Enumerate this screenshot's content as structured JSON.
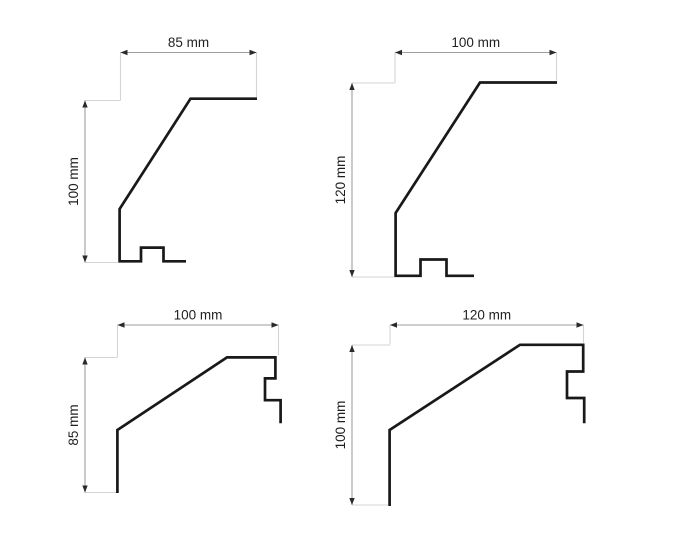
{
  "canvas": {
    "width": 675,
    "height": 540,
    "background": "#ffffff"
  },
  "colors": {
    "profile_stroke": "#191919",
    "dim_line": "#9e9e9e",
    "extension_line": "#d4d4d4",
    "arrow_fill": "#2a2a2a",
    "label_text": "#1f1f1f"
  },
  "diagrams": [
    {
      "name": "top-left-profile",
      "width_label": "85 mm",
      "height_label": "100 mm",
      "width_mm": 85,
      "height_mm": 100,
      "h_dim": {
        "x1": 120.5,
        "x2": 256.5,
        "y": 52.5
      },
      "v_dim": {
        "x": 85,
        "y1": 100.5,
        "y2": 262.5
      },
      "extensions": [
        [
          120.5,
          52.5,
          120.5,
          100.5
        ],
        [
          256.5,
          52.5,
          256.5,
          97.0
        ],
        [
          85,
          100.5,
          120.5,
          100.5
        ],
        [
          85,
          262.5,
          118,
          262.5
        ]
      ],
      "profile_points": [
        [
          257.0,
          98.7
        ],
        [
          190.5,
          98.7
        ],
        [
          119.6,
          209.0
        ],
        [
          119.6,
          261.3
        ],
        [
          141.0,
          261.3
        ],
        [
          141.0,
          247.6
        ],
        [
          163.5,
          247.6
        ],
        [
          163.5,
          261.3
        ],
        [
          186.0,
          261.3
        ]
      ]
    },
    {
      "name": "top-right-profile",
      "width_label": "100 mm",
      "height_label": "120 mm",
      "width_mm": 100,
      "height_mm": 120,
      "h_dim": {
        "x1": 395,
        "x2": 556.5,
        "y": 52.5
      },
      "v_dim": {
        "x": 352,
        "y1": 83,
        "y2": 277
      },
      "extensions": [
        [
          395,
          52.5,
          395,
          83
        ],
        [
          556.5,
          52.5,
          556.5,
          80.5
        ],
        [
          352,
          83,
          395,
          83
        ],
        [
          352,
          277,
          394,
          277
        ]
      ],
      "profile_points": [
        [
          557.0,
          82.5
        ],
        [
          480.0,
          82.5
        ],
        [
          395.6,
          213.0
        ],
        [
          395.6,
          275.8
        ],
        [
          420.5,
          275.8
        ],
        [
          420.5,
          259.5
        ],
        [
          446.5,
          259.5
        ],
        [
          446.5,
          275.8
        ],
        [
          474.0,
          275.8
        ]
      ]
    },
    {
      "name": "bottom-left-profile",
      "width_label": "100 mm",
      "height_label": "85 mm",
      "width_mm": 100,
      "height_mm": 85,
      "h_dim": {
        "x1": 117.5,
        "x2": 278.5,
        "y": 325
      },
      "v_dim": {
        "x": 85,
        "y1": 357.5,
        "y2": 492.5
      },
      "extensions": [
        [
          117.5,
          325,
          117.5,
          357
        ],
        [
          278.5,
          325,
          278.5,
          355
        ],
        [
          85,
          357.5,
          117.5,
          357.5
        ],
        [
          85,
          492.5,
          116,
          492.5
        ]
      ],
      "profile_points": [
        [
          117.4,
          493.0
        ],
        [
          117.4,
          430.0
        ],
        [
          227.0,
          357.4
        ],
        [
          275.4,
          357.4
        ],
        [
          275.4,
          378.4
        ],
        [
          265.0,
          378.4
        ],
        [
          265.0,
          400.2
        ],
        [
          280.6,
          400.2
        ],
        [
          280.6,
          423.3
        ]
      ]
    },
    {
      "name": "bottom-right-profile",
      "width_label": "120 mm",
      "height_label": "100 mm",
      "width_mm": 120,
      "height_mm": 100,
      "h_dim": {
        "x1": 390,
        "x2": 583.5,
        "y": 325
      },
      "v_dim": {
        "x": 352,
        "y1": 345,
        "y2": 505
      },
      "extensions": [
        [
          390,
          325,
          390,
          344.5
        ],
        [
          583.5,
          325,
          583.5,
          343
        ],
        [
          352,
          345,
          390,
          345
        ],
        [
          352,
          505,
          388,
          505
        ]
      ],
      "profile_points": [
        [
          389.6,
          506.0
        ],
        [
          389.6,
          430.0
        ],
        [
          520.0,
          344.8
        ],
        [
          583.2,
          344.8
        ],
        [
          583.2,
          371.5
        ],
        [
          567.0,
          371.5
        ],
        [
          567.0,
          398.0
        ],
        [
          584.2,
          398.0
        ],
        [
          584.2,
          423.3
        ]
      ]
    }
  ]
}
